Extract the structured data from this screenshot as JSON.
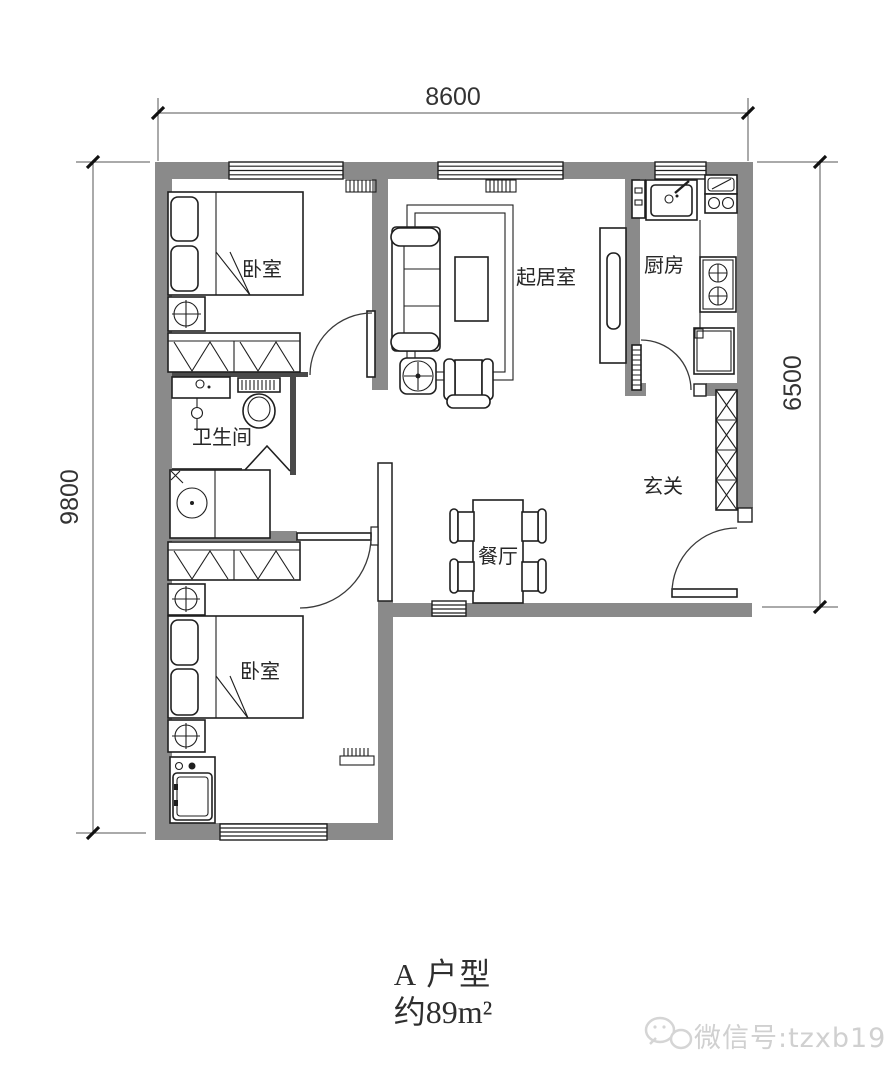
{
  "plan": {
    "dimensions": {
      "top": "8600",
      "left": "9800",
      "right": "6500"
    },
    "rooms": {
      "bedroom_top": "卧室",
      "living": "起居室",
      "kitchen": "厨房",
      "bathroom": "卫生间",
      "entry": "玄关",
      "dining": "餐厅",
      "bedroom_bottom": "卧室"
    },
    "title": {
      "line1": "A 户型",
      "line2": "约89m²"
    },
    "watermark": "微信号:tzxb1986",
    "colors": {
      "wall": "#8a8a8a",
      "line": "#1f1f1f",
      "watermark": "#d0d0d0"
    }
  }
}
